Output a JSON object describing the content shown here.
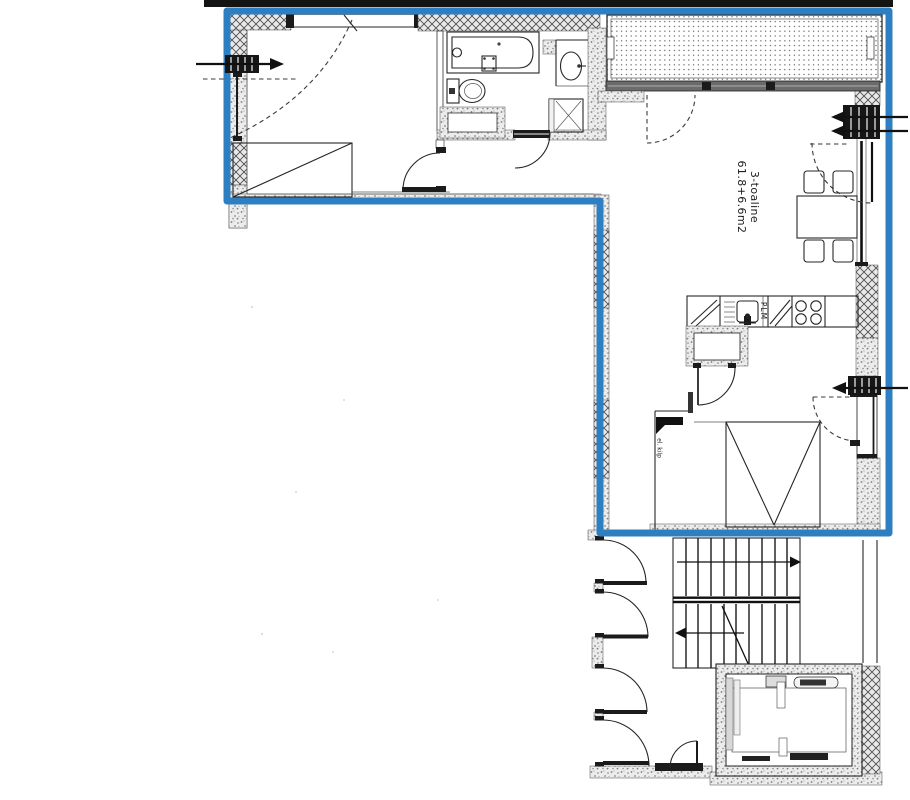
{
  "plan": {
    "apartment_label": "3-toaline",
    "area_label": "61.8+6.6m2",
    "kitchen_label": "PLM",
    "electrical_panel_label": "el. kilp"
  },
  "colors": {
    "boundary": "#2e7fc2",
    "top_bar": "#141414",
    "ink": "#262626"
  }
}
